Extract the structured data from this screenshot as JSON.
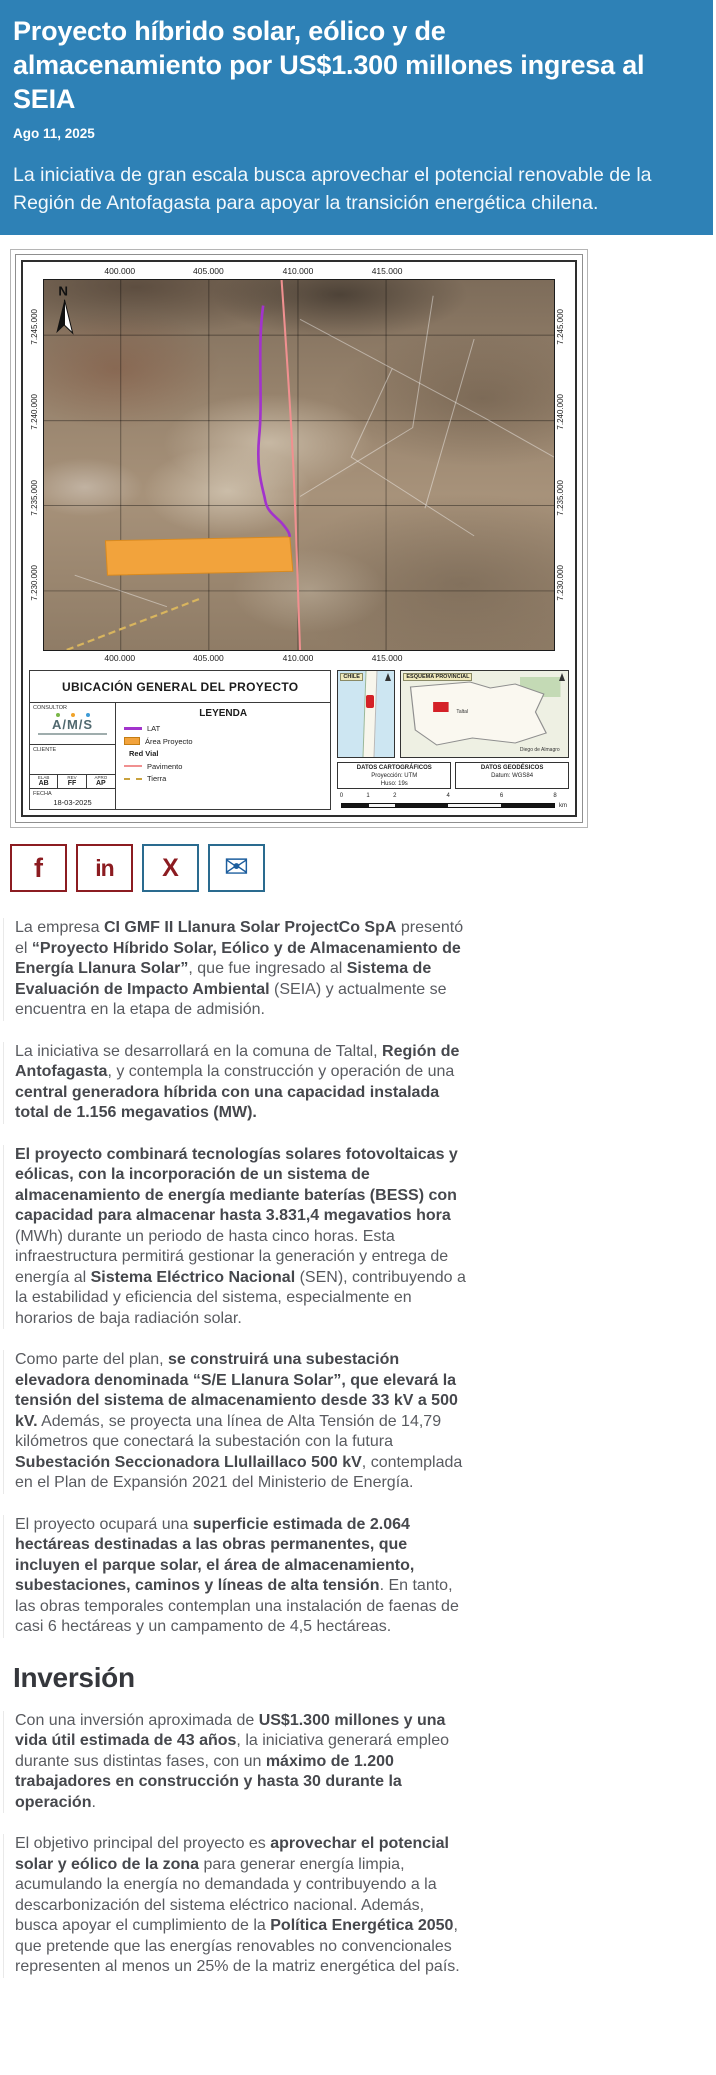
{
  "header": {
    "title": "Proyecto híbrido solar, eólico y de almacenamiento por US$1.300 millones ingresa al SEIA",
    "date": "Ago 11, 2025",
    "subtitle": "La iniciativa de gran escala busca aprovechar el potencial renovable de la Región de Antofagasta para apoyar la transición energética chilena.",
    "bg_color": "#2e81b6"
  },
  "map_figure": {
    "title": "UBICACIÓN GENERAL DEL PROYECTO",
    "north_label": "N",
    "x_ticks": [
      "400.000",
      "405.000",
      "410.000",
      "415.000"
    ],
    "y_ticks": [
      "7.245.000",
      "7.240.000",
      "7.235.000",
      "7.230.000"
    ],
    "feature_colors": {
      "lat_line": "#a233cc",
      "project_area": "#f2a33c",
      "paved_road": "#f09090",
      "dirt_road": "#c9a23e"
    },
    "legend": {
      "heading": "LEYENDA",
      "items": [
        {
          "label": "LAT"
        },
        {
          "label": "Área Proyecto"
        },
        {
          "label": "Red Vial"
        },
        {
          "label": "Pavimento"
        },
        {
          "label": "Tierra"
        }
      ]
    },
    "consultor": {
      "label": "CONSULTOR",
      "logo": "A/M/S"
    },
    "cliente": {
      "label": "CLIENTE"
    },
    "approval_table": {
      "headers": [
        "ELAB",
        "REV",
        "APRO"
      ],
      "values": [
        "AB",
        "FF",
        "AP"
      ]
    },
    "fecha": {
      "label": "FECHA",
      "value": "18-03-2025"
    },
    "insets": {
      "chile": {
        "label": "CHILE"
      },
      "esquema": {
        "label": "ESQUEMA PROVINCIAL",
        "place_1": "Taltal",
        "place_2": "Diego de Almagro"
      }
    },
    "datos_cartograficos": {
      "heading": "DATOS CARTOGRÁFICOS",
      "line_1": "Proyección: UTM",
      "line_2": "Huso: 19s"
    },
    "datos_geodesicos": {
      "heading": "DATOS GEODÉSICOS",
      "line_1": "Datum: WGS84"
    },
    "scale_bar": {
      "ticks": [
        "0",
        "1",
        "2",
        "4",
        "6",
        "8"
      ],
      "unit": "km"
    }
  },
  "share": {
    "buttons": [
      {
        "name": "facebook",
        "glyph": "f"
      },
      {
        "name": "linkedin",
        "glyph": "in"
      },
      {
        "name": "x",
        "glyph": "X"
      },
      {
        "name": "email",
        "glyph": "✉"
      }
    ]
  },
  "article": {
    "heading": "Inversión",
    "paragraphs": [
      {
        "runs": [
          {
            "t": "La empresa ",
            "b": false
          },
          {
            "t": "CI GMF II Llanura Solar ProjectCo SpA",
            "b": true
          },
          {
            "t": " presentó el ",
            "b": false
          },
          {
            "t": "“Proyecto Híbrido Solar, Eólico y de Almacenamiento de Energía Llanura Solar”",
            "b": true
          },
          {
            "t": ", que fue ingresado al ",
            "b": false
          },
          {
            "t": "Sistema de Evaluación de Impacto Ambiental",
            "b": true
          },
          {
            "t": " (SEIA) y actualmente se encuentra en la etapa de admisión.",
            "b": false
          }
        ]
      },
      {
        "runs": [
          {
            "t": "La iniciativa se desarrollará en la comuna de Taltal, ",
            "b": false
          },
          {
            "t": "Región de Antofagasta",
            "b": true
          },
          {
            "t": ", y contempla la construcción y operación de una ",
            "b": false
          },
          {
            "t": "central generadora híbrida con una capacidad instalada total de 1.156 megavatios (MW).",
            "b": true
          }
        ]
      },
      {
        "runs": [
          {
            "t": "El proyecto combinará tecnologías solares fotovoltaicas y eólicas, con la incorporación de un sistema de almacenamiento de energía mediante baterías (BESS) con capacidad para almacenar hasta 3.831,4 megavatios hora",
            "b": true
          },
          {
            "t": " (MWh) durante un periodo de hasta cinco horas. Esta infraestructura permitirá gestionar la generación y entrega de energía al ",
            "b": false
          },
          {
            "t": "Sistema Eléctrico Nacional",
            "b": true
          },
          {
            "t": " (SEN), contribuyendo a la estabilidad y eficiencia del sistema, especialmente en horarios de baja radiación solar.",
            "b": false
          }
        ]
      },
      {
        "runs": [
          {
            "t": "Como parte del plan, ",
            "b": false
          },
          {
            "t": "se construirá una subestación elevadora denominada “S/E Llanura Solar”, que elevará la tensión del sistema de almacenamiento desde 33 kV a 500 kV.",
            "b": true
          },
          {
            "t": " Además, se proyecta una línea de Alta Tensión de 14,79 kilómetros que conectará la subestación con la futura ",
            "b": false
          },
          {
            "t": "Subestación Seccionadora Llullaillaco 500 kV",
            "b": true
          },
          {
            "t": ", contemplada en el Plan de Expansión 2021 del Ministerio de Energía.",
            "b": false
          }
        ]
      },
      {
        "runs": [
          {
            "t": "El proyecto ocupará una ",
            "b": false
          },
          {
            "t": "superficie estimada de 2.064 hectáreas destinadas a las obras permanentes, que incluyen el parque solar, el área de almacenamiento, subestaciones, caminos y líneas de alta tensión",
            "b": true
          },
          {
            "t": ". En tanto, las obras temporales contemplan una instalación de faenas de casi 6 hectáreas y un campamento de 4,5 hectáreas.",
            "b": false
          }
        ]
      },
      {
        "runs": [
          {
            "t": "Con una inversión aproximada de ",
            "b": false
          },
          {
            "t": "US$1.300 millones y una vida útil estimada de 43 años",
            "b": true
          },
          {
            "t": ", la iniciativa generará empleo durante sus distintas fases, con un ",
            "b": false
          },
          {
            "t": "máximo de 1.200 trabajadores en construcción y hasta 30 durante la operación",
            "b": true
          },
          {
            "t": ".",
            "b": false
          }
        ]
      },
      {
        "runs": [
          {
            "t": "El objetivo principal del proyecto es ",
            "b": false
          },
          {
            "t": "aprovechar el potencial solar y eólico de la zona",
            "b": true
          },
          {
            "t": " para generar energía limpia, acumulando la energía no demandada y contribuyendo a la descarbonización del sistema eléctrico nacional. Además, busca apoyar el cumplimiento de la ",
            "b": false
          },
          {
            "t": "Política Energética 2050",
            "b": true
          },
          {
            "t": ", que pretende que las energías renovables no convencionales representen al menos un 25% de la matriz energética del país.",
            "b": false
          }
        ]
      }
    ]
  }
}
